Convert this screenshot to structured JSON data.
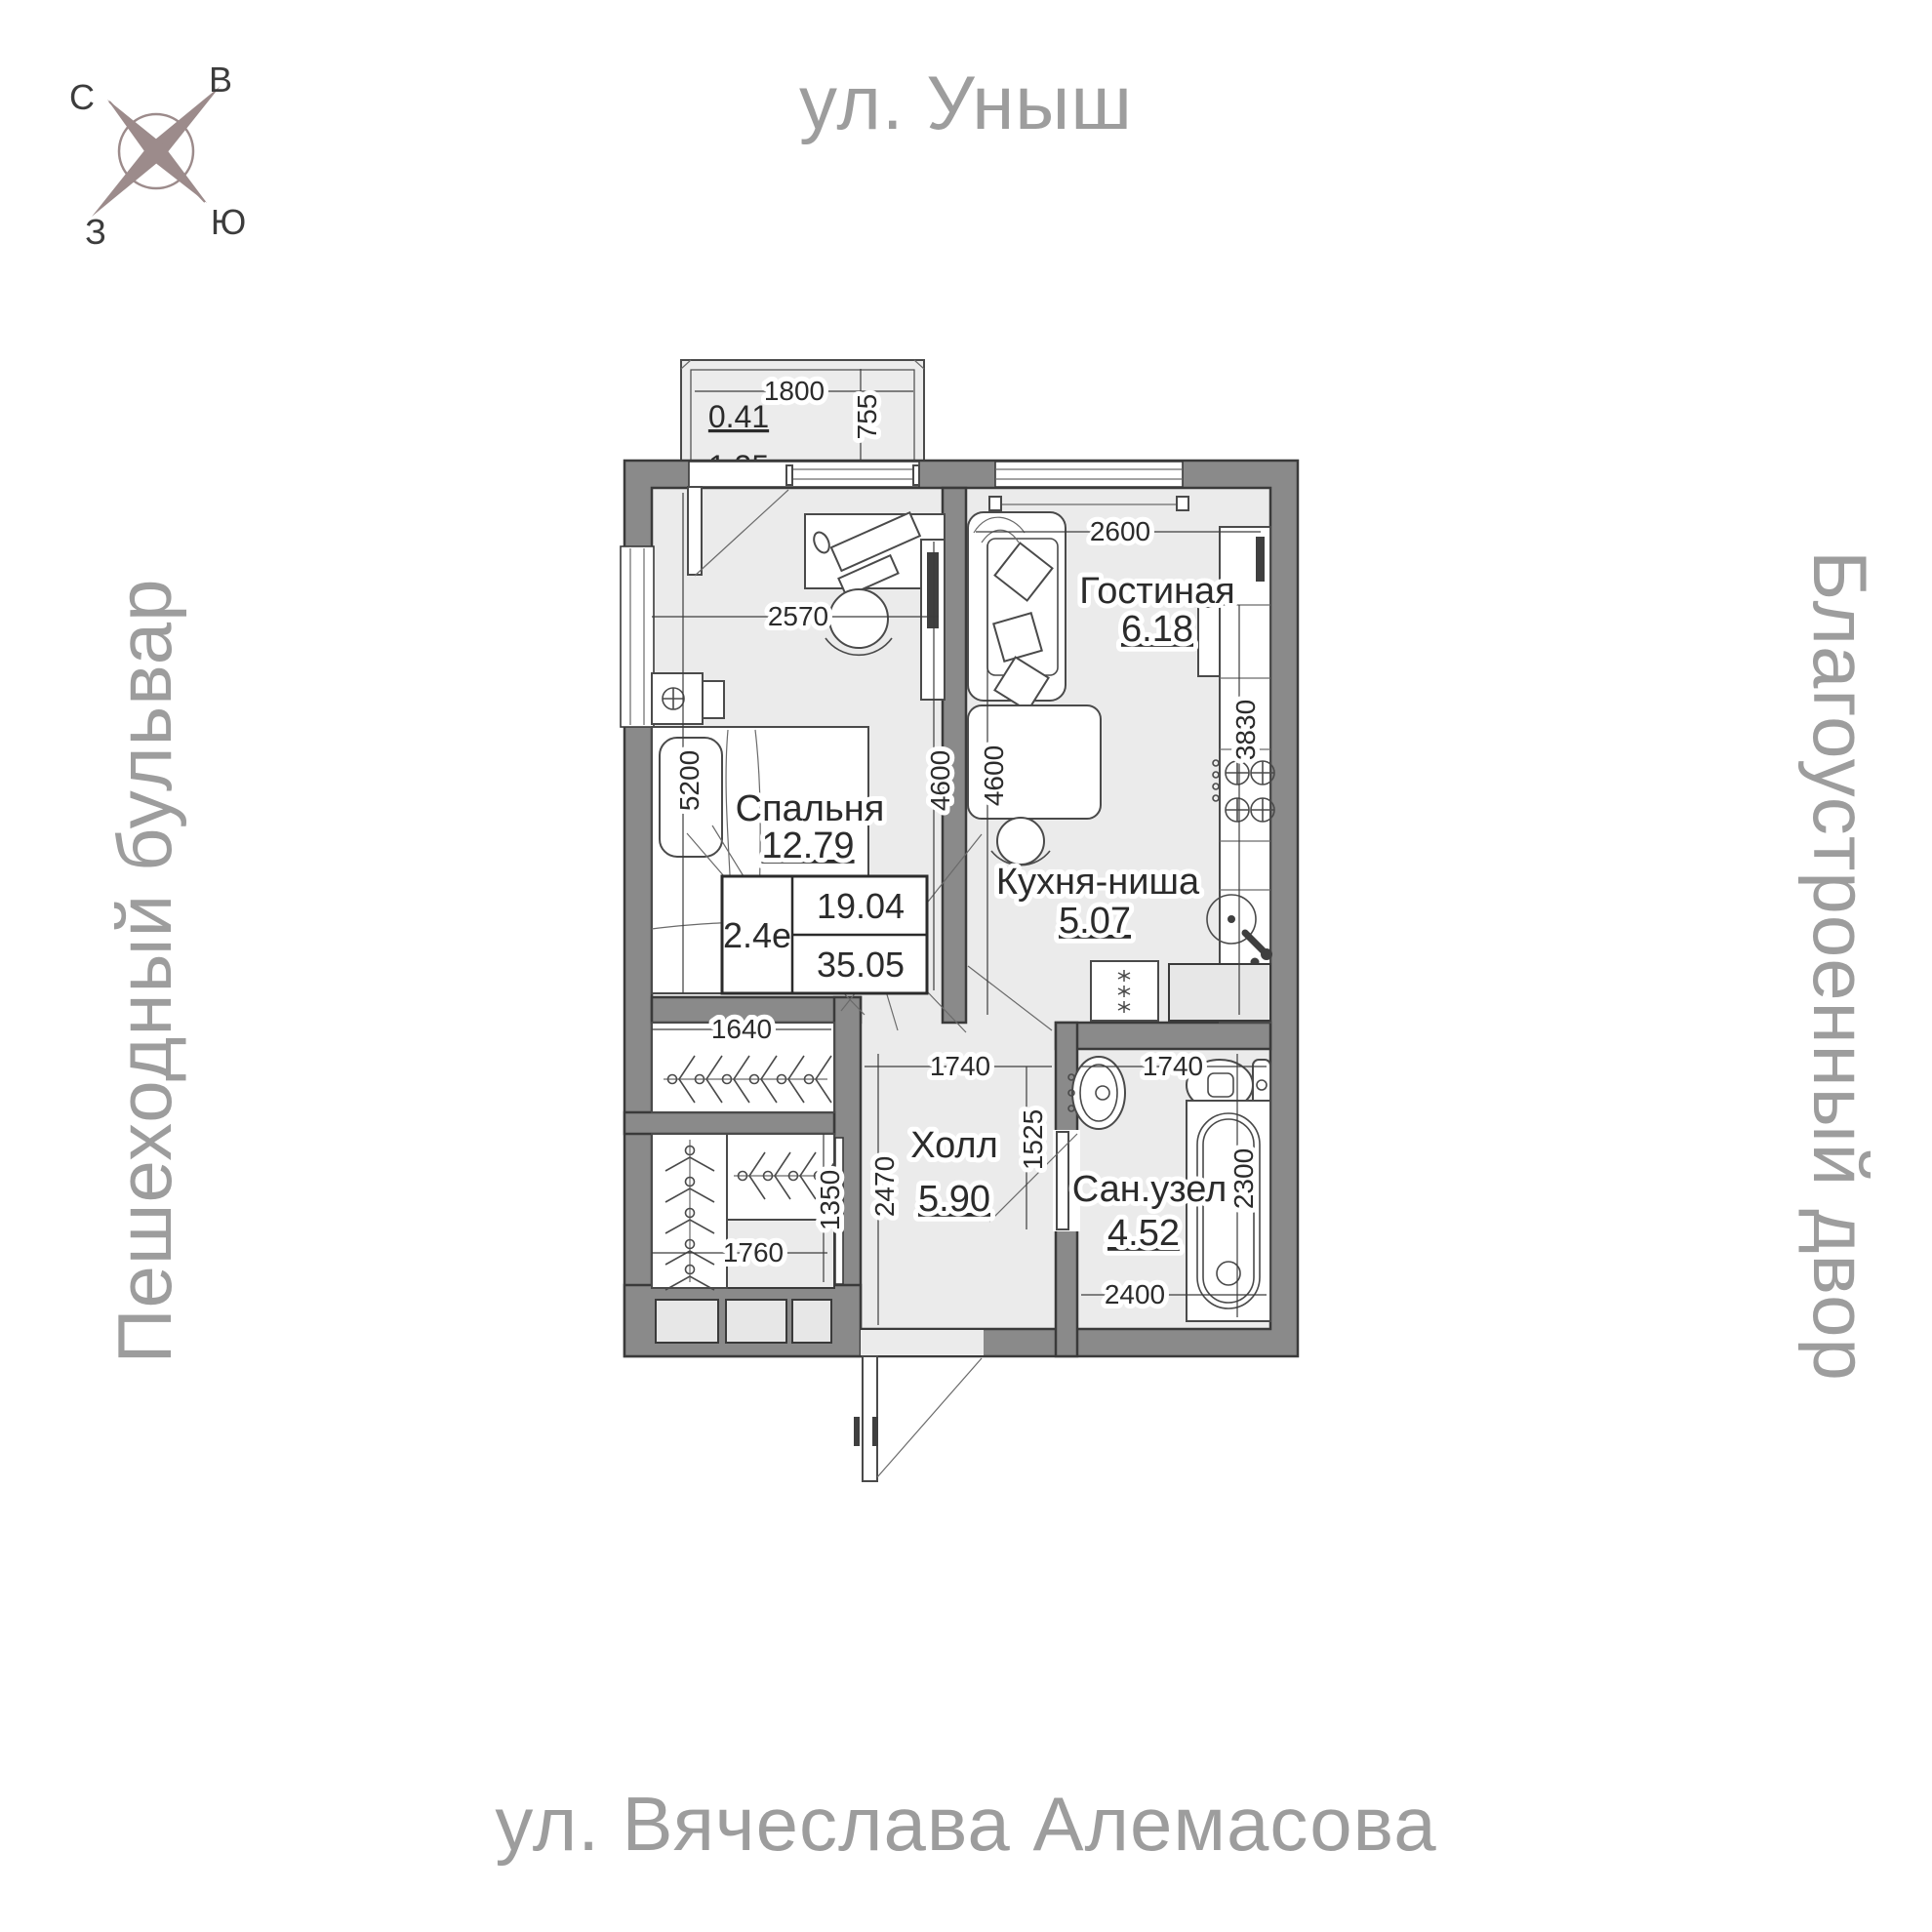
{
  "streets": {
    "top": "ул. Уныш",
    "bottom": "ул. Вячеслава Алемасова",
    "left": "Пешеходный бульвар",
    "right": "Благоустроенный двор"
  },
  "compass": {
    "n": "С",
    "e": "В",
    "w": "З",
    "s": "Ю"
  },
  "rooms": [
    {
      "name": "Спальня",
      "area": "12.79"
    },
    {
      "name": "Гостиная",
      "area": "6.18"
    },
    {
      "name": "Кухня-ниша",
      "area": "5.07"
    },
    {
      "name": "Холл",
      "area": "5.90"
    },
    {
      "name": "Сан.узел",
      "area": "4.52"
    }
  ],
  "balcony": {
    "reduced_area": "0.41",
    "full_area": "1.35"
  },
  "summary": {
    "type": "2.4е",
    "living_area": "19.04",
    "total_area": "35.05"
  },
  "dimensions": {
    "balcony_width": "1800",
    "balcony_depth": "755",
    "bedroom_width": "2570",
    "bedroom_length": "5200",
    "bedroom_side": "4600",
    "living_width": "2600",
    "living_side": "4600",
    "kitchen_side": "3830",
    "closet_top_width": "1640",
    "closet_height": "1350",
    "closet_bottom_width": "1760",
    "hall_width": "1740",
    "hall_niche": "1525",
    "hall_depth": "2470",
    "bath_width": "1740",
    "bath_length": "2300",
    "bath_bottom_width": "2400"
  },
  "colors": {
    "wall": "#8a8a8a",
    "floor": "#ebebeb",
    "street_text": "#9d9d9d",
    "compass_needle": "#9c8b8b",
    "label_text": "#2b2b2b"
  }
}
